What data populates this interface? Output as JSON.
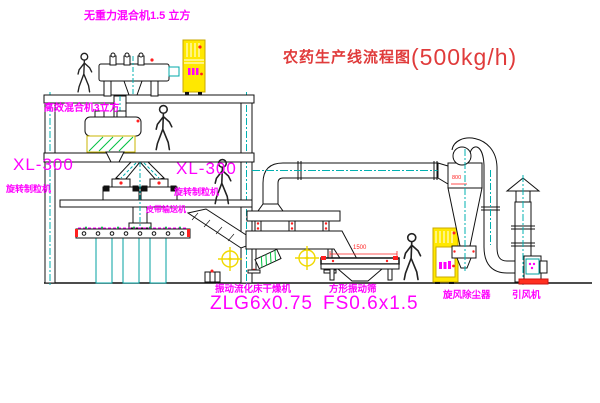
{
  "diagram": {
    "title": {
      "name": "农药生产线流程图",
      "capacity": "(500kg/h)"
    },
    "labels": {
      "top_mixer": "无重力混合机1.5 立方",
      "floor2_mixer": "高效混合机3立方",
      "granulator_left_model": "XL-300",
      "granulator_left_name": "旋转制粒机",
      "granulator_right_model": "XL-300",
      "granulator_right_name": "旋转制粒机",
      "belt_conveyor": "皮带输送机",
      "dryer_name": "振动流化床干燥机",
      "dryer_model": "ZLG6x0.75",
      "sieve_name": "方形振动筛",
      "sieve_model": "FS0.6x1.5",
      "cyclone": "旋风除尘器",
      "fan": "引风机"
    },
    "dimensions": {
      "sieve_length": "1500",
      "cyclone_diameter": "800"
    },
    "icons": {
      "person": "person-icon",
      "control_cabinet": "control-cabinet-icon",
      "flexible_joint": "crosshair-joint-icon"
    },
    "colors": {
      "background": "#ffffff",
      "line": "#1a1a1a",
      "centerline_cyan": "#00b0b0",
      "label_magenta": "#ff00ff",
      "title_red": "#e03b3b",
      "accent_red": "#ff2020",
      "cabinet_yellow": "#ffe800",
      "hatch_green": "#00c040",
      "joint_yellow": "#f0d800"
    }
  }
}
